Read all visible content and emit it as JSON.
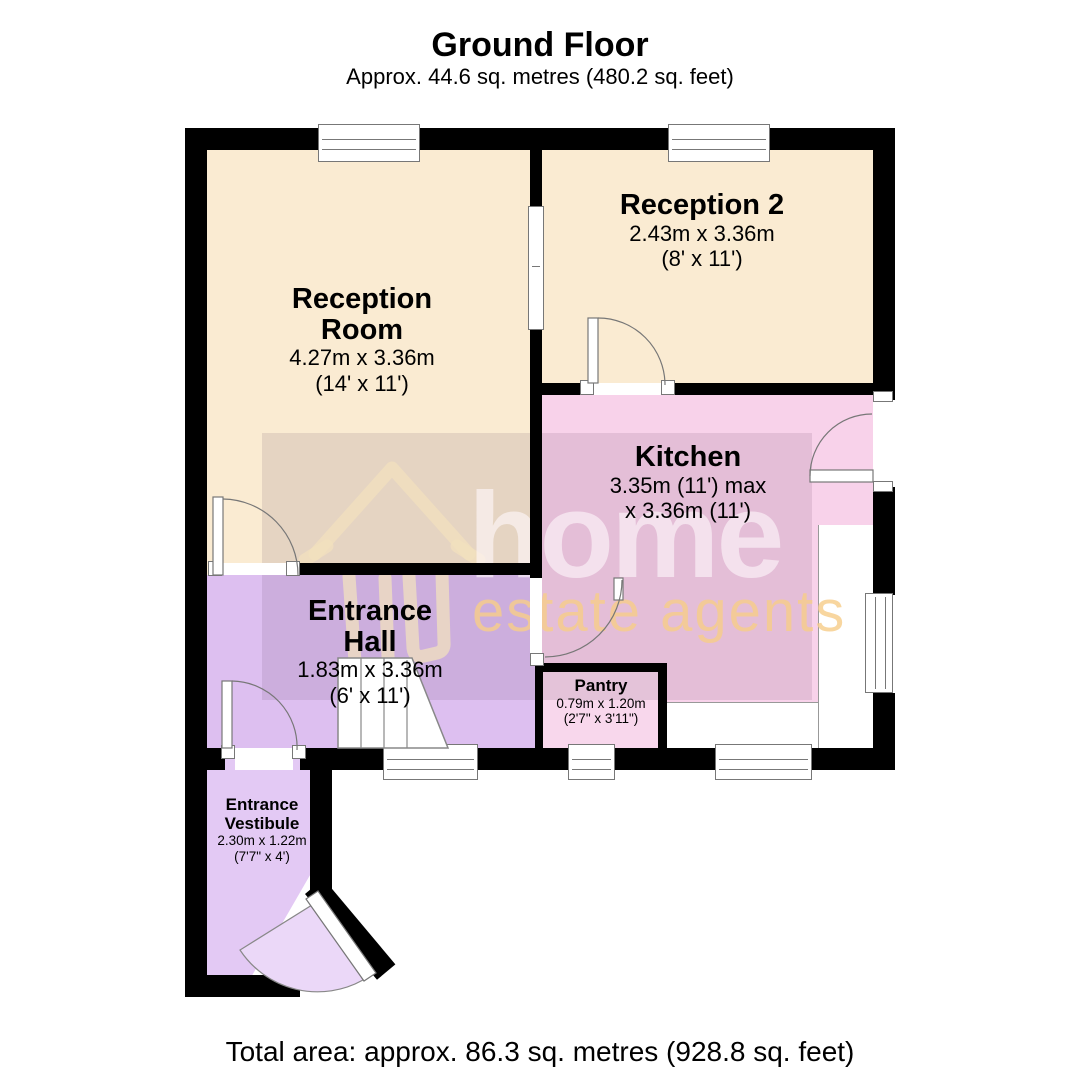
{
  "header": {
    "title": "Ground Floor",
    "subtitle": "Approx. 44.6 sq. metres (480.2 sq. feet)"
  },
  "footer": {
    "total_area": "Total area: approx. 86.3 sq. metres (928.8 sq. feet)"
  },
  "watermark": {
    "brand": "home",
    "tagline": "estate agents"
  },
  "colors": {
    "wall": "#000000",
    "reception_fill": "#FAEBD2",
    "kitchen_fill": "#F8D2EA",
    "hall_fill": "#DDBFF0",
    "vestibule_fill": "#E3C9F4",
    "pantry_fill": "#F8D7EC",
    "door_arc": "#777777",
    "watermark_overlay": "rgba(95,60,95,0.13)",
    "brand_text": "rgba(255,248,252,0.60)",
    "tagline_text": "rgba(247,205,138,0.82)"
  },
  "rooms": {
    "reception_room": {
      "name1": "Reception",
      "name2": "Room",
      "metric": "4.27m x 3.36m",
      "imperial": "(14' x 11')"
    },
    "reception_2": {
      "name1": "Reception 2",
      "metric": "2.43m x 3.36m",
      "imperial": "(8' x 11')"
    },
    "kitchen": {
      "name1": "Kitchen",
      "metric": "3.35m (11') max",
      "imperial": "x 3.36m (11')"
    },
    "entrance_hall": {
      "name1": "Entrance",
      "name2": "Hall",
      "metric": "1.83m x 3.36m",
      "imperial": "(6' x 11')"
    },
    "pantry": {
      "name1": "Pantry",
      "metric": "0.79m x 1.20m",
      "imperial": "(2'7\" x 3'11\")"
    },
    "entrance_vestibule": {
      "name1": "Entrance",
      "name2": "Vestibule",
      "metric": "2.30m x 1.22m",
      "imperial": "(7'7\" x 4')"
    }
  }
}
